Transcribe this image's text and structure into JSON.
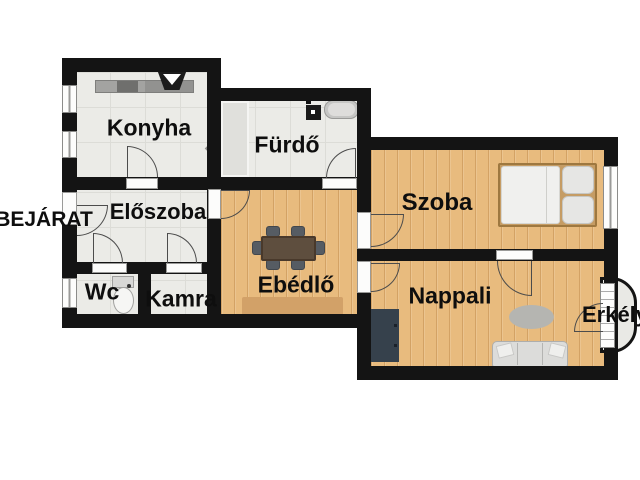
{
  "plan": {
    "type": "apartment-floor-plan",
    "labels": {
      "bejarat": "BEJÁRAT",
      "konyha": "Konyha",
      "furdo": "Fürdő",
      "eloszoba": "Előszoba",
      "wc": "Wc",
      "kamra": "Kamra",
      "ebedlo": "Ebédlő",
      "szoba": "Szoba",
      "nappali": "Nappali",
      "erkely": "Erkély"
    },
    "colors": {
      "wall": "#141414",
      "tile_floor": "#ebebe7",
      "wood_floor": "#e8bb7e",
      "balcony_floor": "#e9e9e5",
      "counter_gray": "#a3a3a1",
      "wardrobe_dark": "#36414c",
      "table_brown": "#5e4e3e",
      "rug_tan": "#d2a168",
      "rug_gray": "#b5b5b1",
      "sofa_gray": "#dcdcda"
    }
  }
}
